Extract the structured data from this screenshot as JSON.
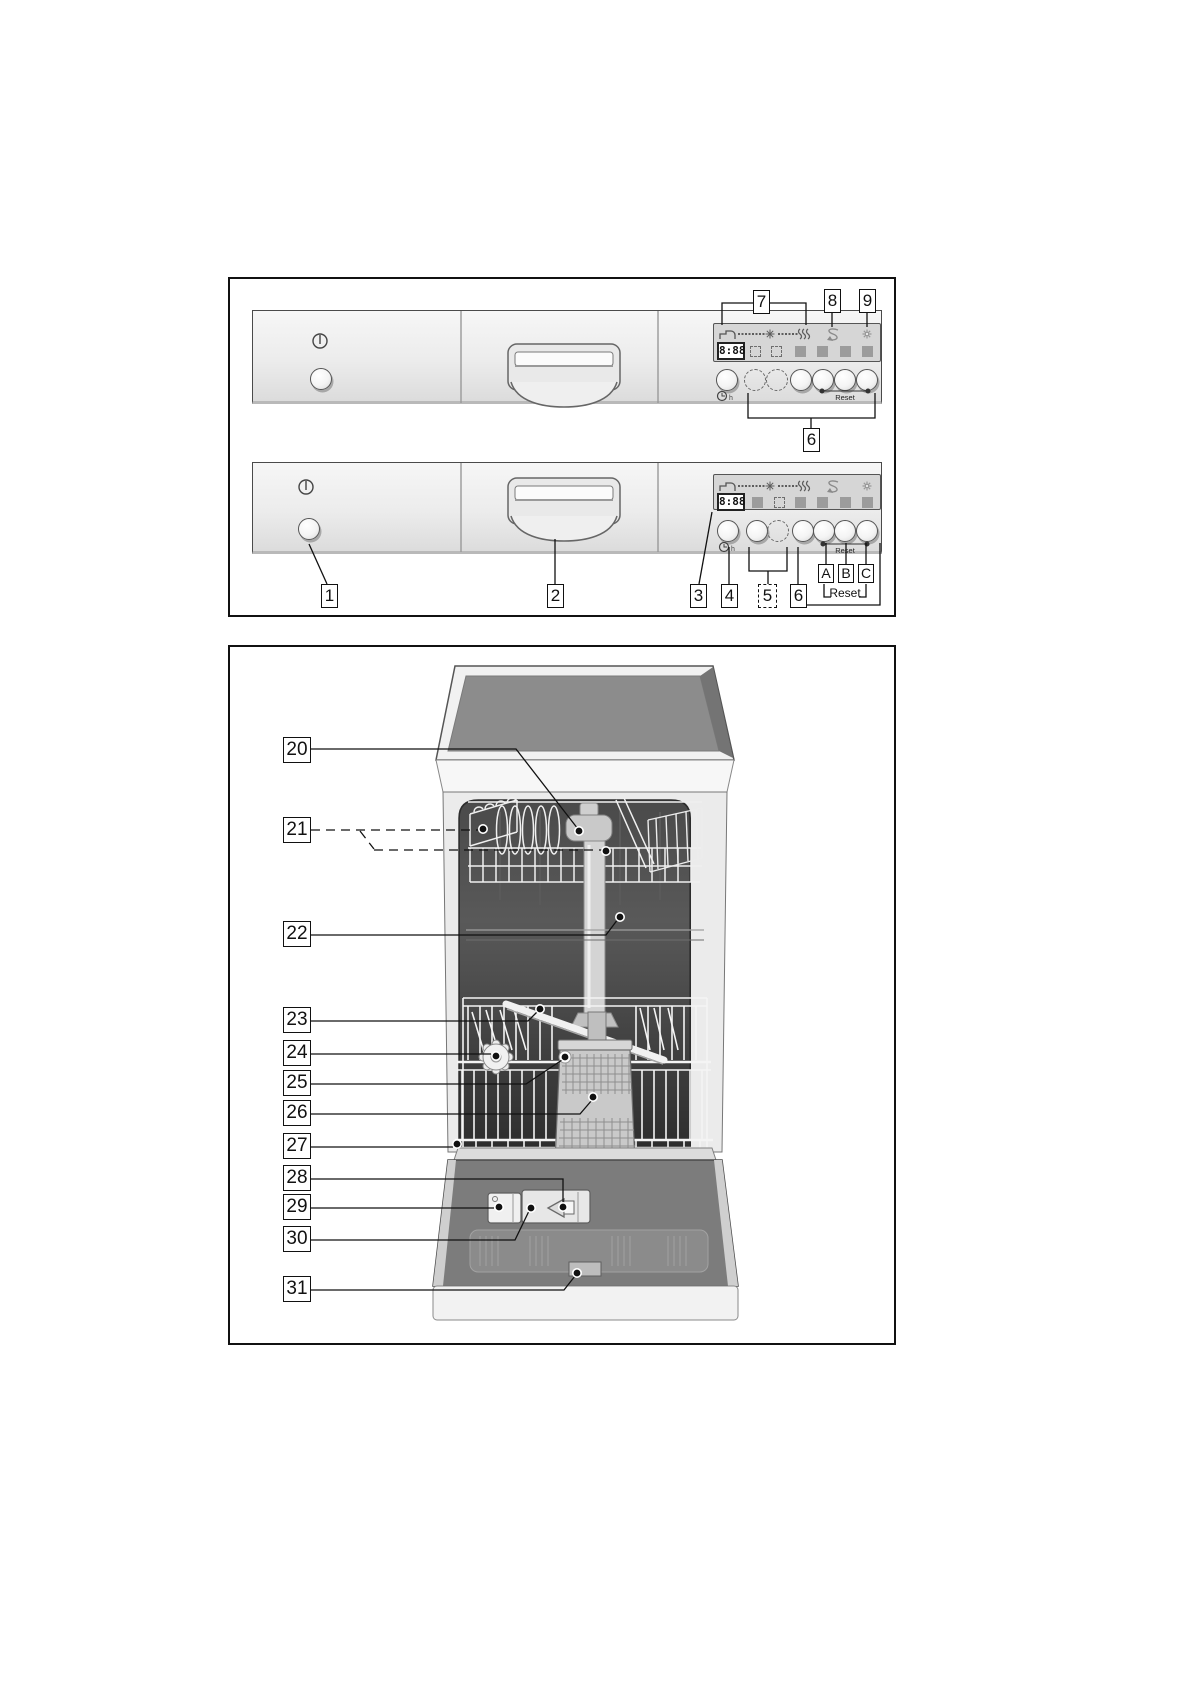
{
  "figure1": {
    "title": "control-panel-variants",
    "display_value": "8:88",
    "panel_reset_label": "Reset",
    "abc_reset_label": "Reset",
    "clock_hours": "h",
    "callouts": {
      "c1": "1",
      "c2": "2",
      "c3": "3",
      "c4": "4",
      "c5": "5",
      "c6": "6",
      "c7": "7",
      "c8": "8",
      "c9": "9",
      "cA": "A",
      "cB": "B",
      "cC": "C"
    }
  },
  "figure2": {
    "title": "dishwasher-interior",
    "callouts": {
      "c20": "20",
      "c21": "21",
      "c22": "22",
      "c23": "23",
      "c24": "24",
      "c25": "25",
      "c26": "26",
      "c27": "27",
      "c28": "28",
      "c29": "29",
      "c30": "30",
      "c31": "31"
    }
  },
  "icons": {
    "power": "power-icon",
    "water_inlet": "water-tap-icon",
    "wash": "sun-icon",
    "dry": "drying-waves-icon",
    "salt": "salt-refill-icon",
    "rinse_aid": "rinse-aid-star-icon",
    "time_delay": "clock-icon"
  },
  "colors": {
    "panel": "#ececec",
    "display_bg": "#d6d6d6",
    "indicator_square": "#9c9c9c",
    "worktop": "#8c8c8c",
    "interior": "#3c3c3c",
    "door": "#7c7c7c",
    "line": "#1a1a1a"
  }
}
